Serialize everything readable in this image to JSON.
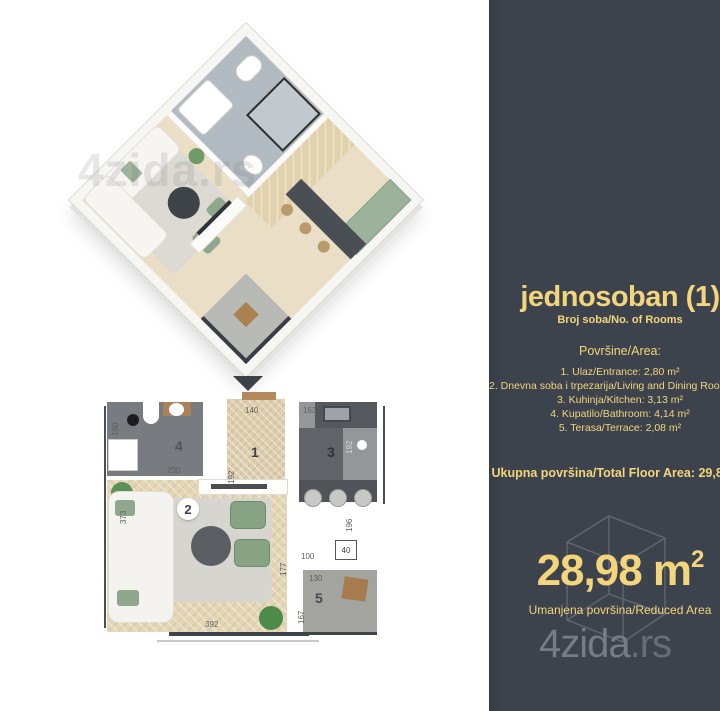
{
  "watermark": "4zida.rs",
  "panel": {
    "title": "jednosoban (1)",
    "subtitle": "Broj soba/No. of Rooms",
    "areas_heading": "Površine/Area:",
    "areas": [
      "1. Ulaz/Entrance: 2,80 m²",
      "2. Dnevna soba i trpezarija/Living and Dining Room: 17,73 m²",
      "3. Kuhinja/Kitchen: 3,13 m²",
      "4. Kupatilo/Bathroom: 4,14 m²",
      "5. Terasa/Terrace: 2,08 m²"
    ],
    "total_area": "Ukupna površina/Total Floor Area: 29,88 m²",
    "reduced_area": {
      "value": "28,98",
      "unit": "m",
      "sup": "2",
      "label": "Umanjena površina/Reduced Area"
    },
    "brand": {
      "name": "4zida",
      "tld": ".rs"
    },
    "colors": {
      "panel_bg": "#3d434d",
      "accent": "#f3d57b",
      "brand_gray": "#767c84"
    }
  },
  "plan2d": {
    "rooms": {
      "hall": "1",
      "living": "2",
      "kitchen": "3",
      "bathroom": "4",
      "terrace": "5"
    },
    "dims": {
      "hall_w": "140",
      "hall_h": "192",
      "kitchen_w": "163",
      "kitchen_h": "192",
      "kitchen_b": "196",
      "bath_h": "180",
      "bath_w": "230",
      "living_h": "373",
      "living_w": "392",
      "terrace_gap": "100",
      "terrace_outer_h": "177",
      "terrace_w": "130",
      "terrace_h": "167",
      "shaft": "40"
    }
  }
}
